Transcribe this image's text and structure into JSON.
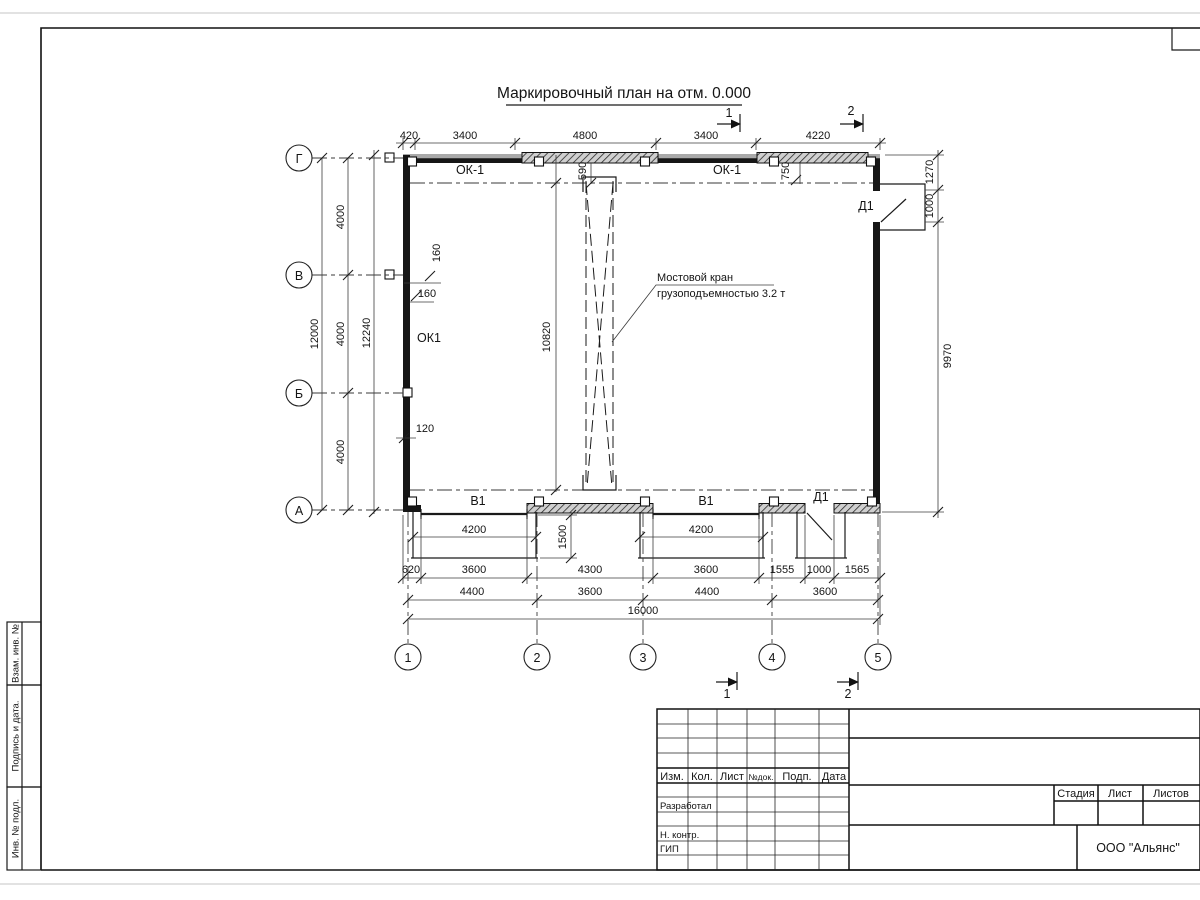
{
  "sheet": {
    "title": "Маркировочный план на отм. 0.000",
    "company": "ООО \"Альянс\""
  },
  "axis_circles": {
    "rows": [
      "Г",
      "В",
      "Б",
      "А"
    ],
    "cols": [
      "1",
      "2",
      "3",
      "4",
      "5"
    ]
  },
  "plan_labels": {
    "ok1_top_left": "ОК-1",
    "ok1_top_right": "ОК-1",
    "ok1_wall": "ОК1",
    "v1_left": "В1",
    "v1_right": "В1",
    "d1_top": "Д1",
    "d1_bottom": "Д1"
  },
  "crane_note": {
    "line1": "Мостовой кран",
    "line2": "грузоподъемностью 3.2 т"
  },
  "section_marks": {
    "top": [
      "1",
      "2"
    ],
    "bottom": [
      "1",
      "2"
    ]
  },
  "dims": {
    "top": [
      "420",
      "3400",
      "4800",
      "3400",
      "4220"
    ],
    "left": {
      "overall": "12000",
      "bays": [
        "4000",
        "4000",
        "4000"
      ],
      "inner": "12240"
    },
    "right": {
      "r1270": "1270",
      "r1000": "1000",
      "r9970": "9970"
    },
    "interior": {
      "crane": "10820",
      "d590": "590",
      "d750": "750",
      "p160v": "160",
      "p160h": "160",
      "p120": "120"
    },
    "gates": {
      "left": "4200",
      "right": "4200",
      "depth": "1500"
    },
    "row1": [
      "620",
      "3600",
      "4300",
      "3600",
      "1555",
      "1000",
      "1565"
    ],
    "row2": [
      "4400",
      "3600",
      "4400",
      "3600"
    ],
    "overall": "16000"
  },
  "titleblock": {
    "header": [
      "Изм.",
      "Кол.",
      "Лист",
      "№док.",
      "Подп.",
      "Дата"
    ],
    "rows": [
      "Разработал",
      "Н. контр.",
      "ГИП"
    ],
    "stage_header": [
      "Стадия",
      "Лист",
      "Листов"
    ]
  },
  "side_stamp": [
    "Взам. инв. №",
    "Подпись  и  дата.",
    "Инв. № подл."
  ]
}
